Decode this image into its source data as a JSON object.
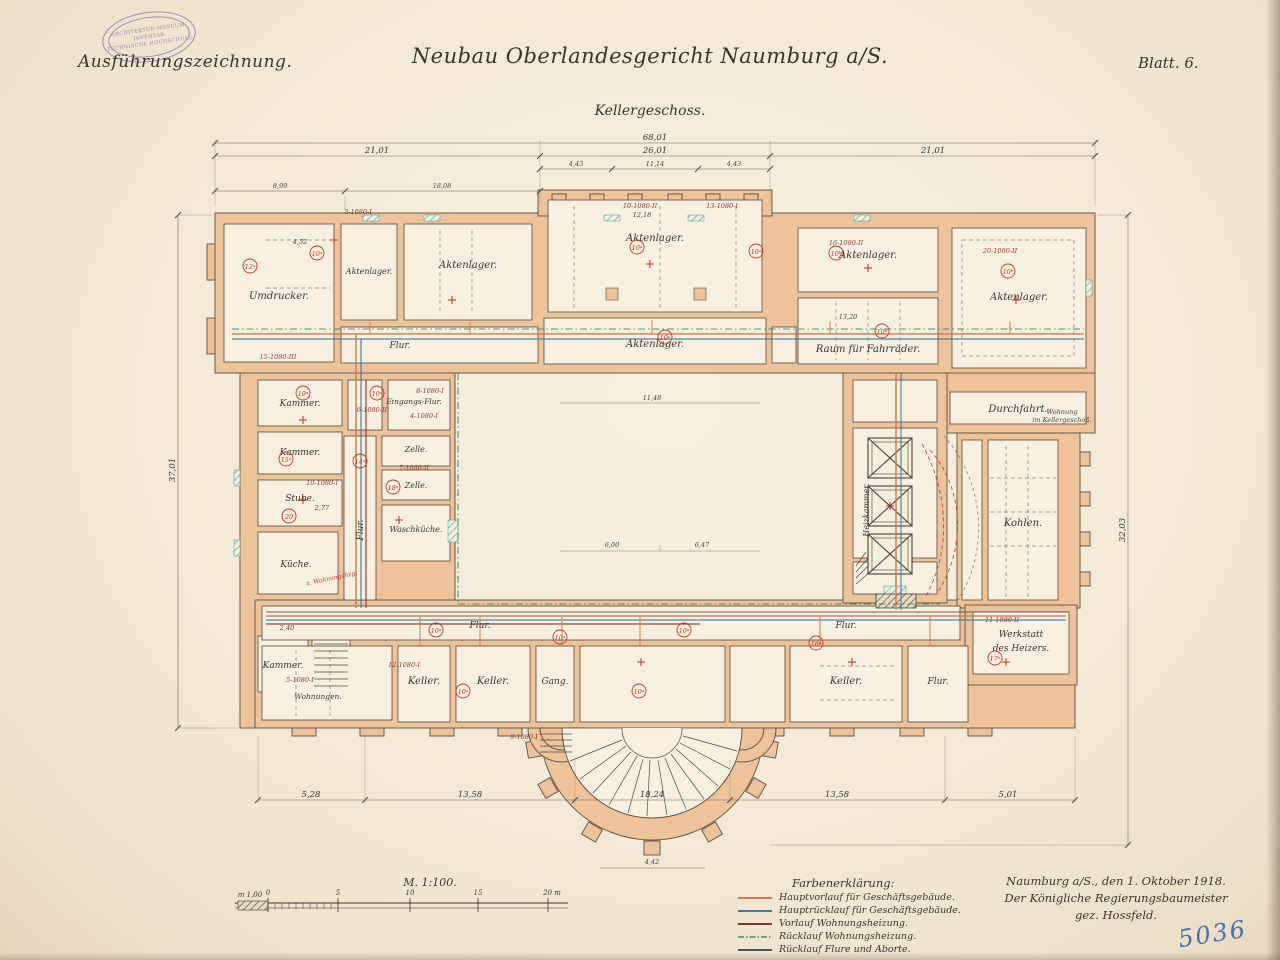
{
  "page": {
    "annotation_top_left": "Ausführungszeichnung.",
    "title": "Neubau Oberlandesgericht Naumburg a/S.",
    "subtitle": "Kellergeschoss.",
    "sheet": "Blatt. 6.",
    "inventory_number": "5036"
  },
  "stamp": {
    "line1": "ARCHITEKTUR-MUSEUM",
    "line2": "INVENTAR",
    "line3": "TECHNISCHE HOCHSCHULE"
  },
  "scale": {
    "label": "M. 1:100.",
    "ticks": [
      "m 1,00",
      "0",
      "5",
      "10",
      "15",
      "20 m"
    ]
  },
  "legend": {
    "title": "Farbenerklärung:",
    "items": [
      {
        "label": "Hauptvorlauf für Geschäftsgebäude.",
        "color": "#cf7a4e",
        "style": "solid"
      },
      {
        "label": "Hauptrücklauf für Geschäftsgebäude.",
        "color": "#3f7ba1",
        "style": "solid"
      },
      {
        "label": "Vorlauf Wohnungsheizung.",
        "color": "#94332a",
        "style": "solid"
      },
      {
        "label": "Rücklauf Wohnungsheizung.",
        "color": "#3f8c5c",
        "style": "dashdot"
      },
      {
        "label": "Rücklauf Flure und Aborte.",
        "color": "#50505a",
        "style": "solid"
      }
    ]
  },
  "signature": {
    "line1": "Naumburg a/S., den 1. Oktober 1918.",
    "line2": "Der Königliche Regierungsbaumeister",
    "line3": "gez. Hossfeld."
  },
  "rooms": [
    {
      "label": "Umdrucker."
    },
    {
      "label": "Aktenlager."
    },
    {
      "label": "Aktenlager."
    },
    {
      "label": "Aktenlager."
    },
    {
      "label": "Aktenlager."
    },
    {
      "label": "Aktenlager."
    },
    {
      "label": "Aktenlager."
    },
    {
      "label": "Raum für Fahrräder."
    },
    {
      "label": "Durchfahrt."
    },
    {
      "label": "Flur."
    },
    {
      "label": "Kammer."
    },
    {
      "label": "Eingangs-Flur."
    },
    {
      "label": "Kammer."
    },
    {
      "label": "Zelle."
    },
    {
      "label": "Zelle."
    },
    {
      "label": "Stube."
    },
    {
      "label": "Waschküche."
    },
    {
      "label": "Flur."
    },
    {
      "label": "Küche."
    },
    {
      "label": "Kammer."
    },
    {
      "label": "Wohnungen."
    },
    {
      "label": "Flur."
    },
    {
      "label": "Keller."
    },
    {
      "label": "Keller."
    },
    {
      "label": "Gang."
    },
    {
      "label": "Keller."
    },
    {
      "label": "Flur."
    },
    {
      "label": "Flur."
    },
    {
      "l1": "Werkstatt",
      "l2": "des Heizers."
    },
    {
      "label": "Kohlen."
    },
    {
      "label": "Heizkammer."
    }
  ],
  "codes": [
    "15-1080-III",
    "3-1080-I",
    "10-1080-II",
    "13-1080-I",
    "16-1080-II",
    "20-1080-II",
    "6-1080-II",
    "8-1080-I",
    "4-1080-I",
    "10-1080-I",
    "7-1080-II",
    "12-1080-I",
    "9-1080-I",
    "11-1080-II",
    "5-1080-I"
  ],
  "markers": [
    "12ᵃ",
    "10ᵃ",
    "10ᵃ",
    "10ᵃ",
    "10ᵃ",
    "10ᵇ",
    "10ᵇ",
    "10ᵇ",
    "19ᵃ",
    "10ᵃ",
    "15ᵃ",
    "14ᵃ",
    "18ᵃ",
    "20",
    "10ᵃ",
    "10ᵃ",
    "10ᵃ",
    "10ᵃ",
    "10ᵃ",
    "16ᵃ",
    "17ᵃ"
  ],
  "dims": {
    "top_total": "68,01",
    "top_left": "21,01",
    "top_mid": "26,01",
    "top_right": "21,01",
    "top_sub": [
      "4,43",
      "11,14",
      "4,43"
    ],
    "top_left2": [
      "8,99",
      "18,08"
    ],
    "bottom": [
      "5,28",
      "13,58",
      "18,24",
      "13,58",
      "5,01"
    ],
    "apse": "4,42",
    "left_v": "37,01",
    "right_v": "32,03",
    "small": [
      "4,52",
      "12,18",
      "11,48",
      "13,20",
      "2,77",
      "6,00",
      "6,47",
      "2,40"
    ]
  },
  "annotations": {
    "red_note": "z. Wohnungshzg.",
    "wing_note_l1": "Wohnung",
    "wing_note_l2": "im Kellergeschoß."
  }
}
